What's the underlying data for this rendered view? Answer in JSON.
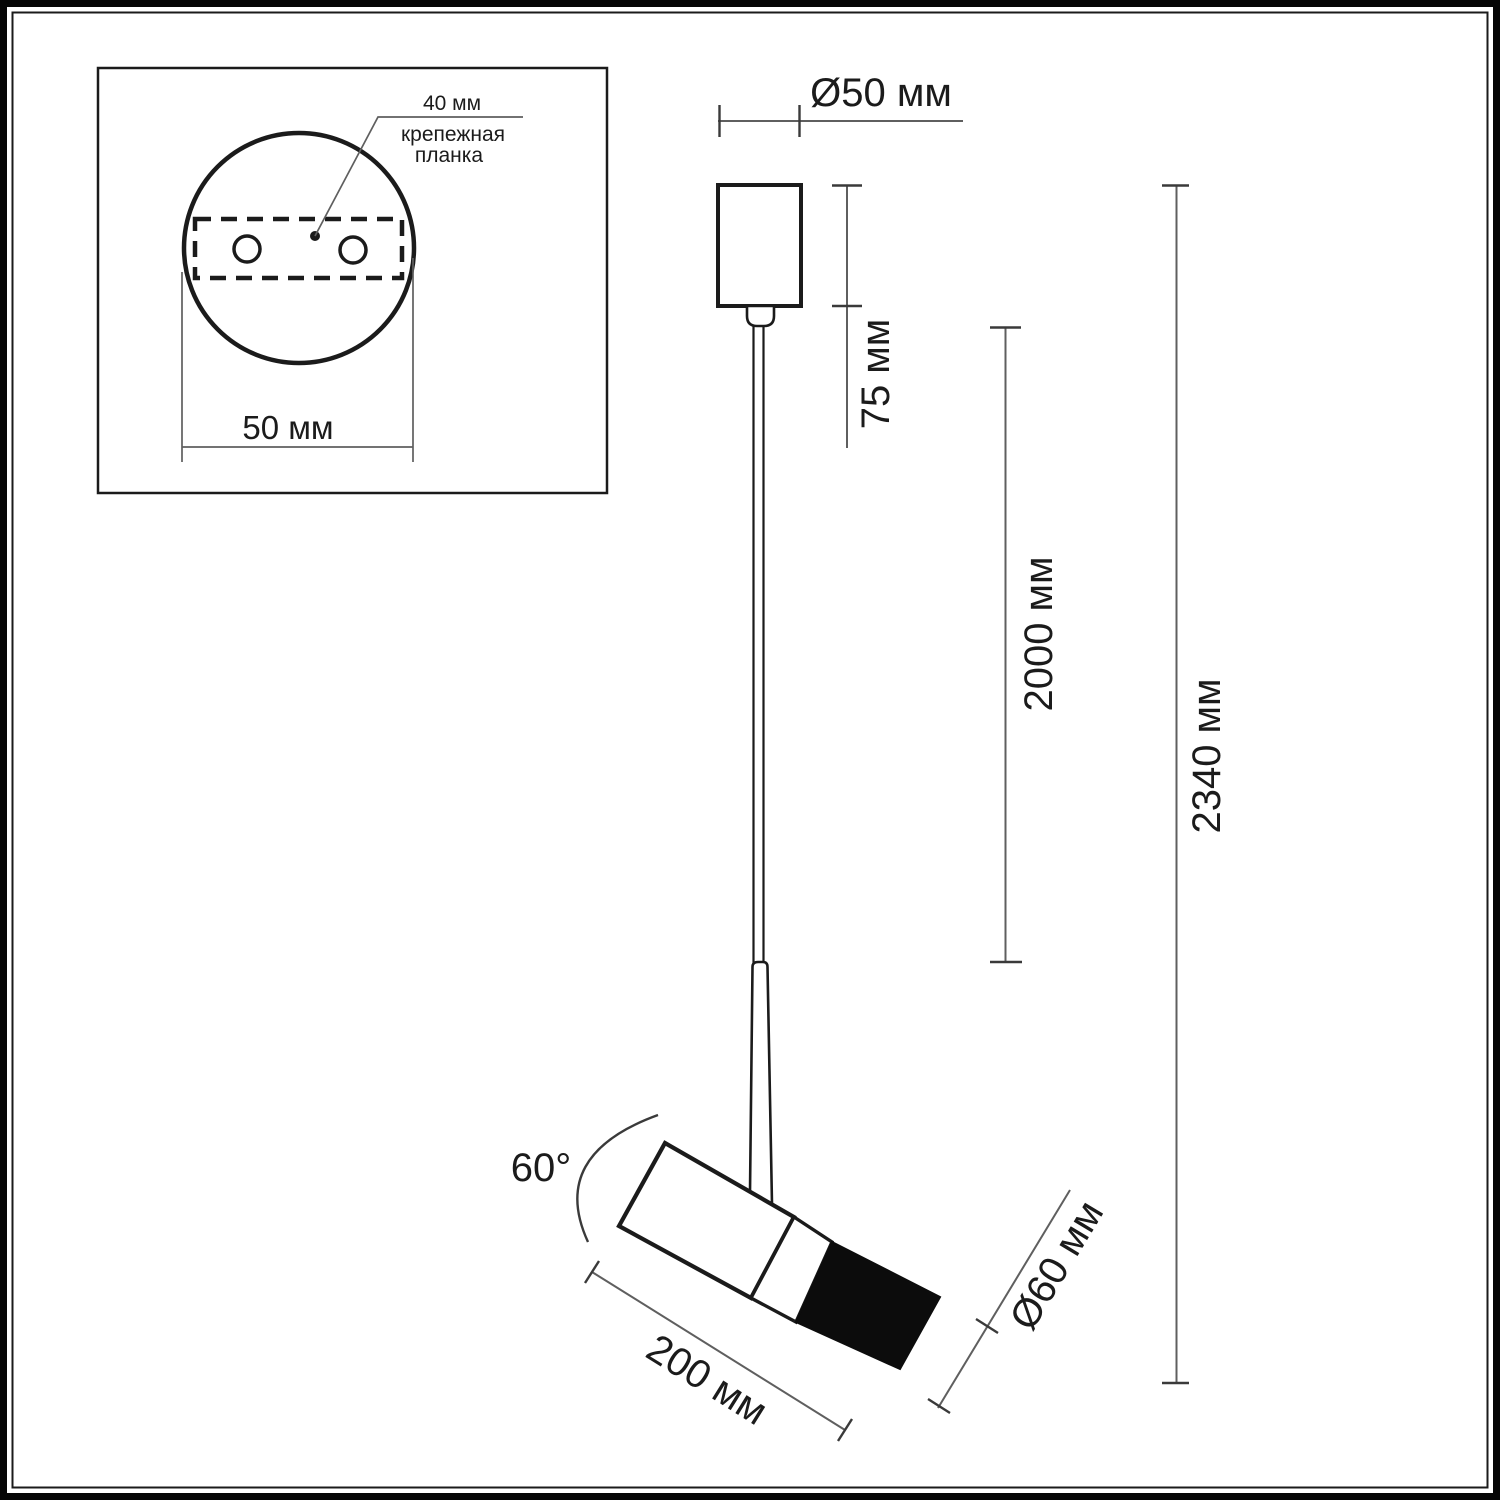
{
  "figure": {
    "kind": "pendant spotlight dimensional drawing"
  },
  "inset": {
    "hole_spacing": "40 мм",
    "mounting_plate_line1": "крепежная",
    "mounting_plate_line2": "планка",
    "base_width": "50 мм"
  },
  "main": {
    "canopy_diameter": "Ø50 мм",
    "canopy_height": "75 мм",
    "cable_length": "2000 мм",
    "total_height": "2340 мм",
    "head_tilt": "60°",
    "head_length": "200 мм",
    "head_diameter": "Ø60 мм"
  },
  "values_mm": {
    "hole_spacing": 40,
    "base_width": 50,
    "canopy_diameter": 50,
    "canopy_height": 75,
    "cable_length": 2000,
    "total_height": 2340,
    "head_length": 200,
    "head_diameter": 60,
    "head_tilt_deg": 60
  },
  "colors": {
    "ink": "#1b1b1b",
    "dim_line": "#5f5f5f",
    "dim_tick": "#3a3a3a",
    "head_fill": "#0c0c0c",
    "background": "#ffffff"
  }
}
